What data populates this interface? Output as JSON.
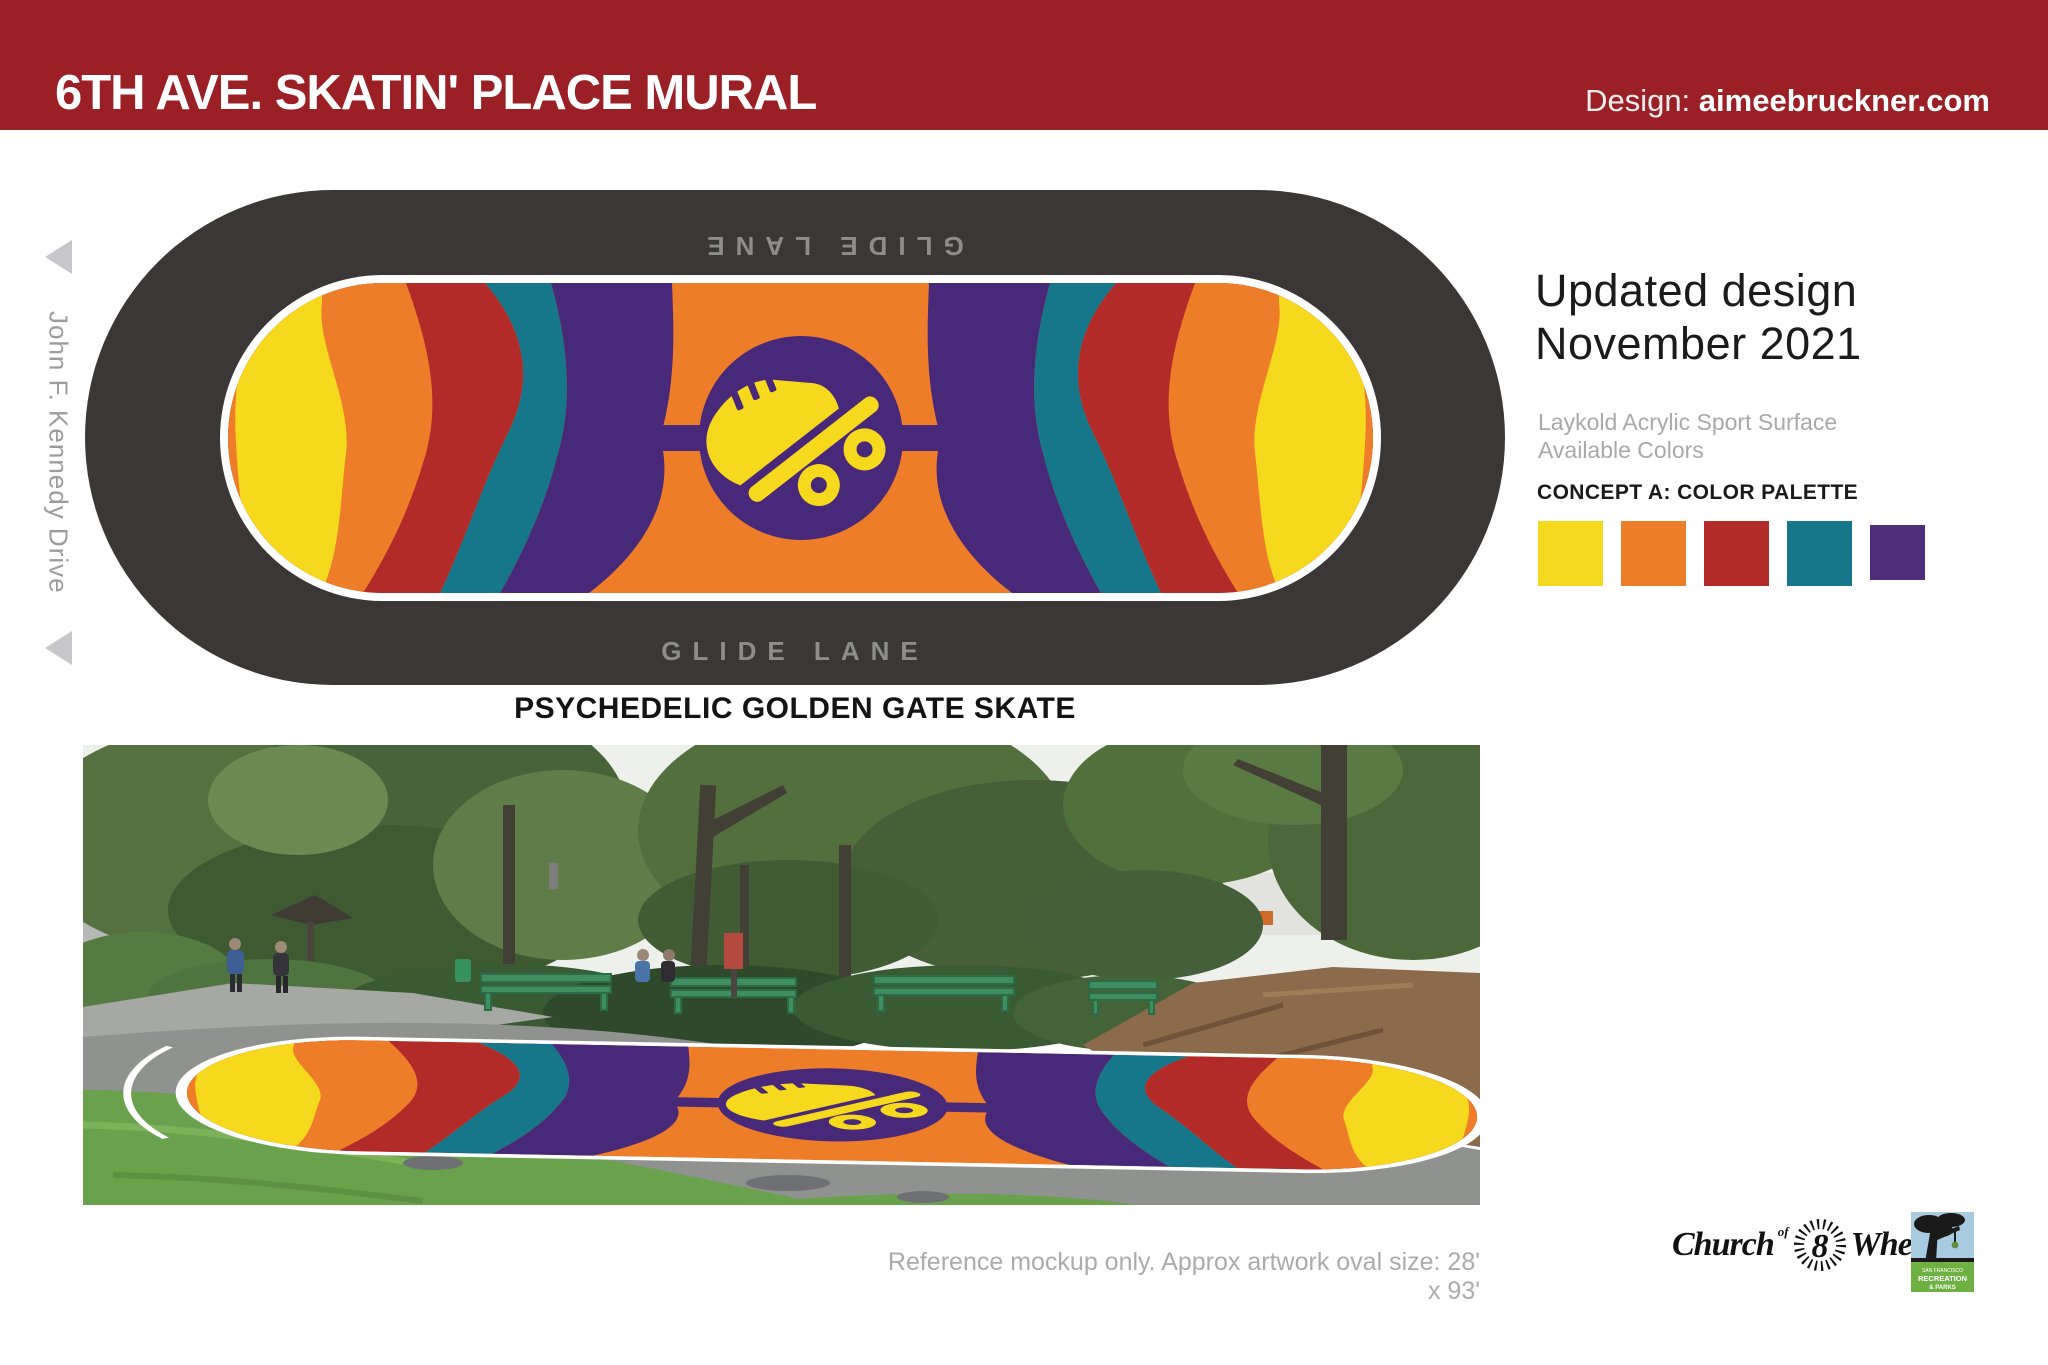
{
  "header": {
    "title": "6TH AVE. SKATIN' PLACE MURAL",
    "design_label": "Design:",
    "design_site": "aimeebruckner.com",
    "bg": "#9A2025"
  },
  "street_label": "John F. Kennedy Drive",
  "rink": {
    "lane_label_top": "GLIDE LANE",
    "lane_label_bottom": "GLIDE LANE",
    "caption": "PSYCHEDELIC GOLDEN GATE SKATE",
    "track_color": "#3A3736"
  },
  "panel": {
    "heading_line1": "Updated design",
    "heading_line2": "November 2021",
    "subtext_line1": "Laykold Acrylic Sport Surface",
    "subtext_line2": "Available Colors",
    "palette_label": "CONCEPT A: COLOR PALETTE",
    "palette": [
      "#F5D91F",
      "#EE7D2A",
      "#B22B28",
      "#17778A",
      "#4F2D7A"
    ]
  },
  "art_colors": {
    "orange": "#EE7D2A",
    "yellow": "#F6D91D",
    "red": "#B22B28",
    "teal": "#17778A",
    "purple": "#482878"
  },
  "photo": {
    "caption": "Reference mockup only. Approx artwork oval size: 28' x 93'"
  },
  "logos": {
    "church": {
      "word1": "Church",
      "of": "of",
      "number": "8",
      "word2": "Wheels"
    },
    "sfrp": {
      "line1": "SAN FRANCISCO",
      "line2": "RECREATION",
      "line3": "& PARKS"
    }
  }
}
